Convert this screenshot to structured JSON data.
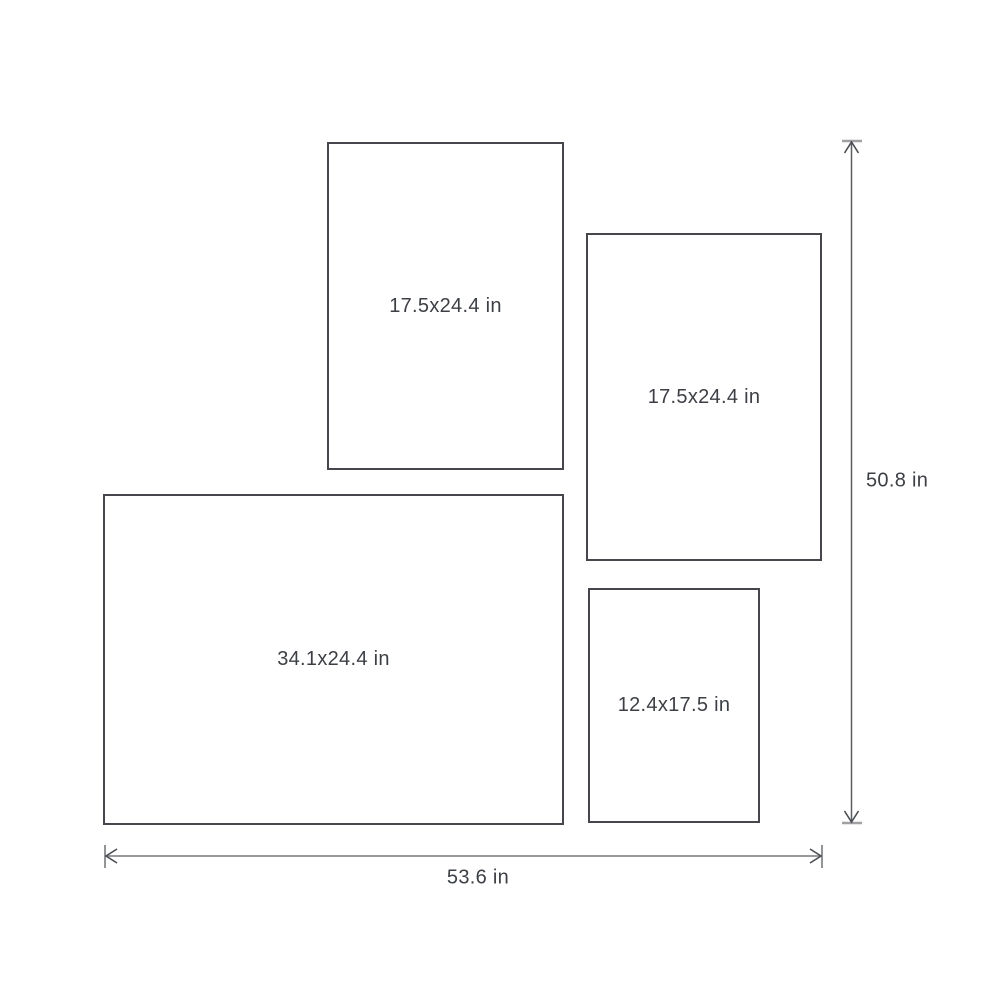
{
  "diagram": {
    "type": "frame-size-layout",
    "unit": "in"
  },
  "frames": [
    {
      "id": "frame-top-left",
      "label": "17.5x24.4 in"
    },
    {
      "id": "frame-right",
      "label": "17.5x24.4 in"
    },
    {
      "id": "frame-bottom-left",
      "label": "34.1x24.4 in"
    },
    {
      "id": "frame-bottom-right",
      "label": "12.4x17.5 in"
    }
  ],
  "dimensions": {
    "height_label": "50.8 in",
    "width_label": "53.6 in"
  },
  "colors": {
    "background": "#ffffff",
    "frame_border": "#45474c",
    "text": "#3c3f44",
    "vertical_dimension_line": "#5a5d61",
    "horizontal_dimension_line": "#9b989b",
    "dimension_end_cap": "#a3a0a3",
    "arrowhead": "#4a4d51"
  }
}
